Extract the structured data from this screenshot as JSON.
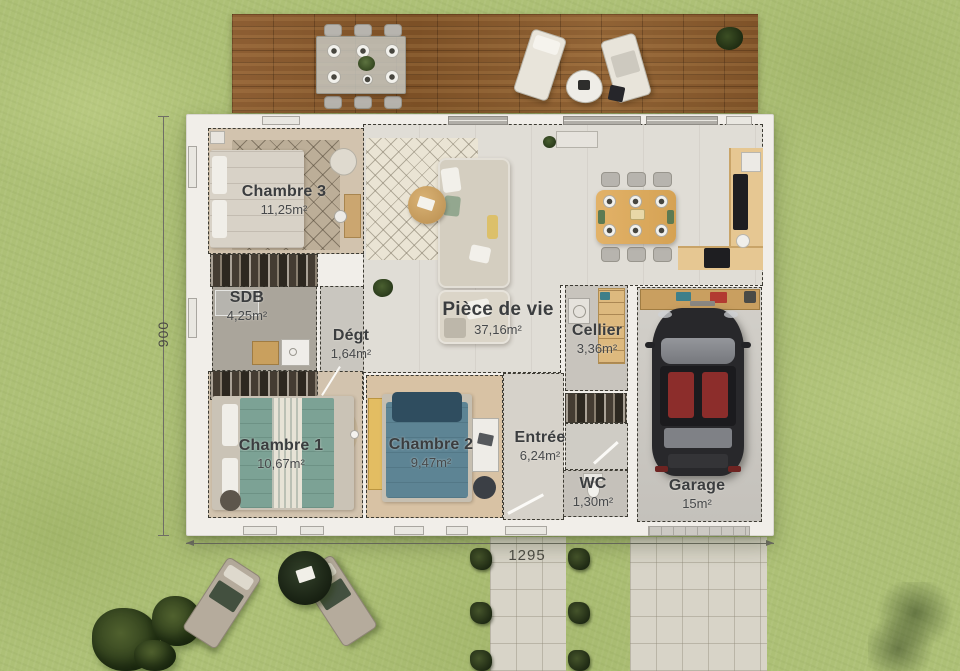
{
  "plan": {
    "rooms": [
      {
        "id": "chambre3",
        "name": "Chambre 3",
        "area": "11,25m²"
      },
      {
        "id": "sdb",
        "name": "SDB",
        "area": "4,25m²"
      },
      {
        "id": "degt",
        "name": "Dégt",
        "area": "1,64m²"
      },
      {
        "id": "piece-de-vie",
        "name": "Pièce de vie",
        "area": "37,16m²"
      },
      {
        "id": "cellier",
        "name": "Cellier",
        "area": "3,36m²"
      },
      {
        "id": "chambre1",
        "name": "Chambre 1",
        "area": "10,67m²"
      },
      {
        "id": "chambre2",
        "name": "Chambre 2",
        "area": "9,47m²"
      },
      {
        "id": "entree",
        "name": "Entrée",
        "area": "6,24m²"
      },
      {
        "id": "wc",
        "name": "WC",
        "area": "1,30m²"
      },
      {
        "id": "garage",
        "name": "Garage",
        "area": "15m²"
      }
    ],
    "dimensions": {
      "height_cm": "900",
      "width_cm": "1295"
    },
    "colors": {
      "grass": "#adc076",
      "deck": "#875831",
      "wall": "#f1eee9",
      "label": "#3b3d3f"
    }
  }
}
